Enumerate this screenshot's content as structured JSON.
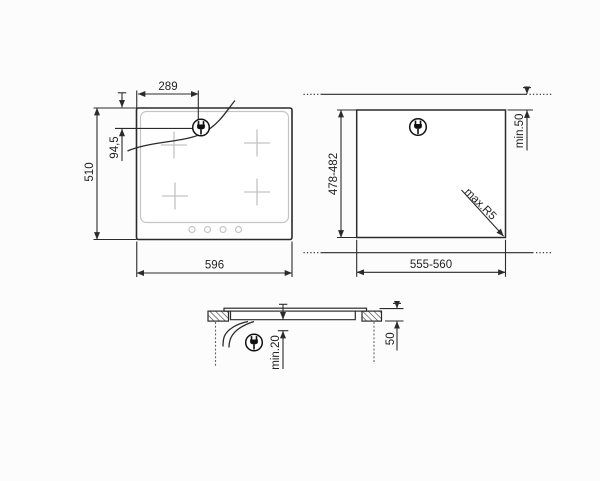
{
  "colors": {
    "line": "#2b2b2b",
    "muted": "#c4c4c4",
    "background": "#fcfcfc"
  },
  "icons": {
    "power_plug": "power-plug"
  },
  "hob_top_view": {
    "width_mm": "596",
    "height_mm": "510",
    "plug_offset_x_mm": "289",
    "plug_offset_y_mm": "94,5"
  },
  "cutout_view": {
    "width_mm": "555-560",
    "height_mm": "478-482",
    "rear_clearance_mm": "min.50",
    "corner_radius": "max.R5"
  },
  "section_view": {
    "under_clearance_mm": "min.20",
    "edge_distance_mm": "50"
  }
}
